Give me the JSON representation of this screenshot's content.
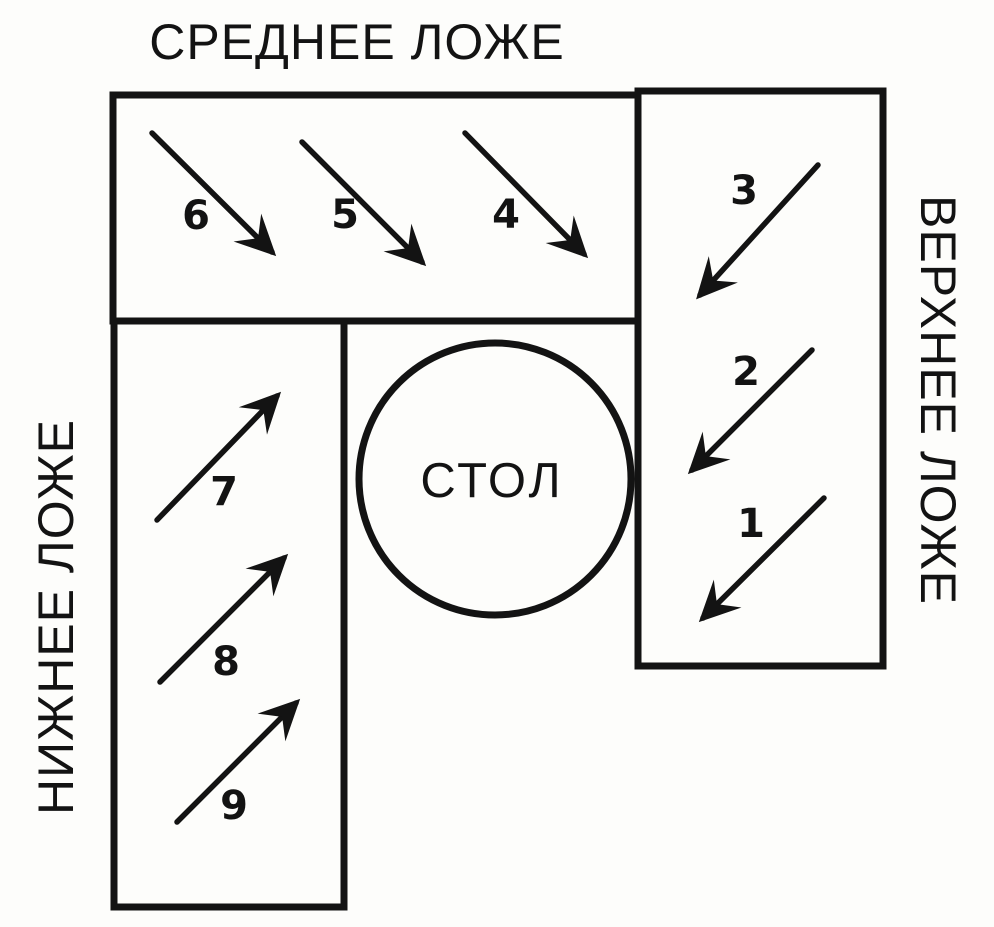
{
  "diagram": {
    "table_label": "СТОЛ",
    "colors": {
      "ink": "#131313",
      "paper": "#fdfdfb"
    },
    "sections": {
      "middle": {
        "label": "СРЕДНЕЕ ЛОЖЕ",
        "position": "top",
        "arrow_direction": "down-right",
        "seats": [
          "6",
          "5",
          "4"
        ]
      },
      "upper": {
        "label": "ВЕРХНЕЕ ЛОЖЕ",
        "position": "right",
        "arrow_direction": "down-left",
        "seats": [
          "3",
          "2",
          "1"
        ]
      },
      "lower": {
        "label": "НИЖНЕЕ ЛОЖЕ",
        "position": "left",
        "arrow_direction": "up-right",
        "seats": [
          "7",
          "8",
          "9"
        ]
      }
    }
  }
}
